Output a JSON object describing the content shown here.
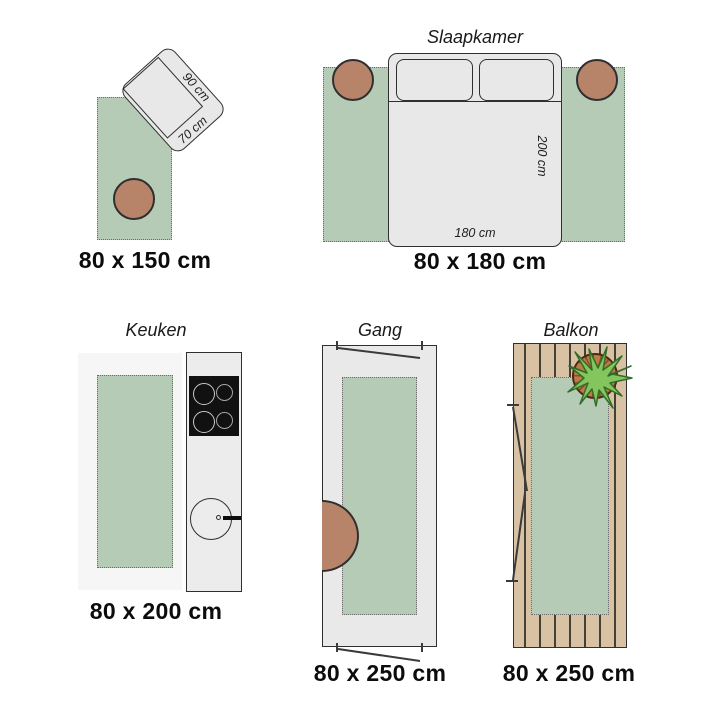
{
  "colors": {
    "rug_green": "#b5cbb6",
    "furniture_gray": "#e8e8e8",
    "outline_dark": "#2f2f2f",
    "stool_brown": "#b7846a",
    "deck_tan": "#d9c2a4",
    "pot_terracotta": "#c07a45",
    "plant_green": "#85c55e",
    "stove_black": "#111111"
  },
  "panels": {
    "rug_80x150": {
      "caption": "80 x 150 cm",
      "chair_width_label": "90 cm",
      "chair_depth_label": "70 cm"
    },
    "slaapkamer": {
      "title": "Slaapkamer",
      "caption": "80 x 180 cm",
      "bed_length_label": "200 cm",
      "bed_width_label": "180 cm"
    },
    "keuken": {
      "title": "Keuken",
      "caption": "80 x 200 cm"
    },
    "gang": {
      "title": "Gang",
      "caption": "80 x 250 cm"
    },
    "balkon": {
      "title": "Balkon",
      "caption": "80 x 250 cm"
    }
  }
}
